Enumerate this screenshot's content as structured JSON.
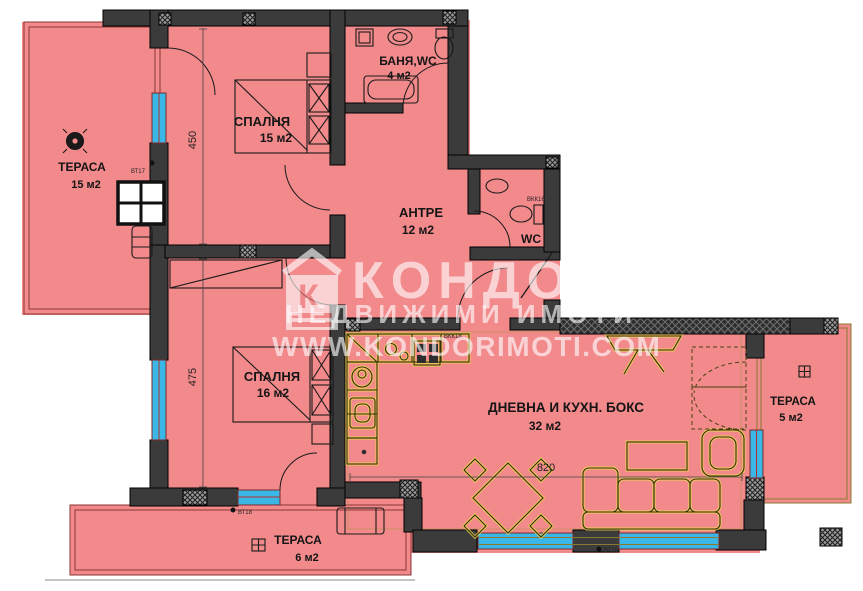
{
  "title": "apartment-floor-plan",
  "watermark": {
    "brand": "КОНДОР",
    "tagline": "НЕДВИЖИМИ ИМОТИ",
    "website": "WWW.KONDORIMOTI.COM",
    "logo_letter": "К"
  },
  "rooms": {
    "bedroom1": {
      "name": "СПАЛНЯ",
      "area": "15 м2"
    },
    "bathroom": {
      "name": "БАНЯ,WC",
      "area": "4 м2"
    },
    "hallway": {
      "name": "АНТРЕ",
      "area": "12 м2"
    },
    "wc": {
      "name": "WC"
    },
    "bedroom2": {
      "name": "СПАЛНЯ",
      "area": "16 м2"
    },
    "living": {
      "name": "ДНЕВНА И КУХН. БОКС",
      "area": "32 м2"
    },
    "terrace_left": {
      "name": "ТЕРАСА",
      "area": "15 м2"
    },
    "terrace_bottom": {
      "name": "ТЕРАСА",
      "area": "6 м2"
    },
    "terrace_right": {
      "name": "ТЕРАСА",
      "area": "5 м2"
    }
  },
  "dimensions": {
    "d450": "450",
    "d475": "475",
    "d820": "820"
  },
  "markers": {
    "bt17": "ВТ17",
    "bt18": "ВТ18",
    "bt15": "ВТ15",
    "bkk16": "ВКК16",
    "bkk18": "ВКК18"
  },
  "colors": {
    "floor": "#f2898b",
    "wall": "#3b3b3b",
    "window": "#3ab7e6",
    "furniture_accent": "#edd34f",
    "terrace_border": "#8a3535",
    "watermark": "#ffffff"
  }
}
